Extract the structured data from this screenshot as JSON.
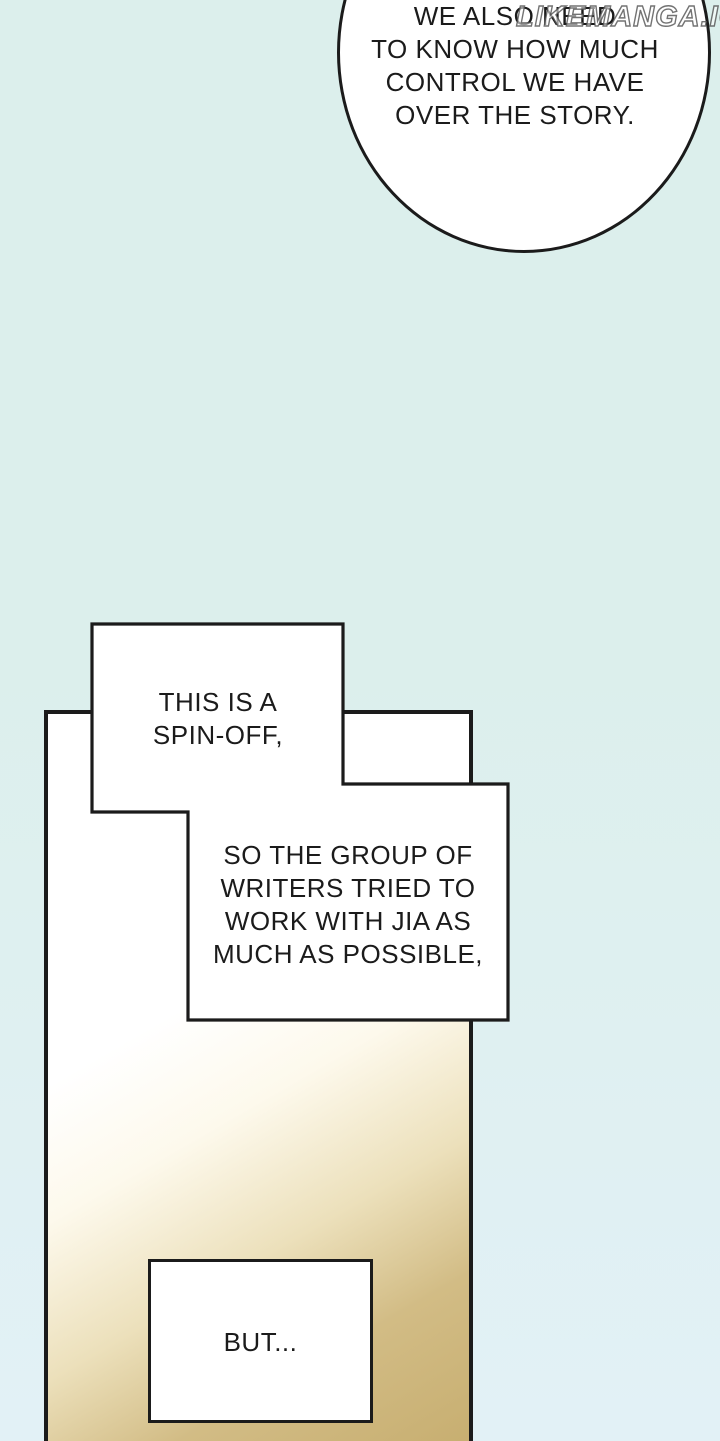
{
  "colors": {
    "bg-top": "#dcefec",
    "bg-bottom": "#e2f1f6",
    "ink": "#1b1b1b",
    "bubble-fill": "#ffffff",
    "tan-1": "#fdf9ec",
    "tan-2": "#ece0bb",
    "tan-3": "#d2bc85",
    "tan-4": "#c7ae70"
  },
  "watermark": {
    "text": "LIKEMANGA.IO"
  },
  "speech_bubble": {
    "lines": [
      "WE ALSO NEED",
      "TO KNOW HOW MUCH",
      "CONTROL WE HAVE",
      "OVER THE STORY."
    ]
  },
  "caption_a": {
    "lines": [
      "THIS IS A",
      "SPIN-OFF,"
    ]
  },
  "caption_b": {
    "lines": [
      "SO THE GROUP OF",
      "WRITERS TRIED TO",
      "WORK WITH JIA AS",
      "MUCH AS POSSIBLE,"
    ]
  },
  "caption_but": {
    "lines": [
      "BUT..."
    ]
  }
}
